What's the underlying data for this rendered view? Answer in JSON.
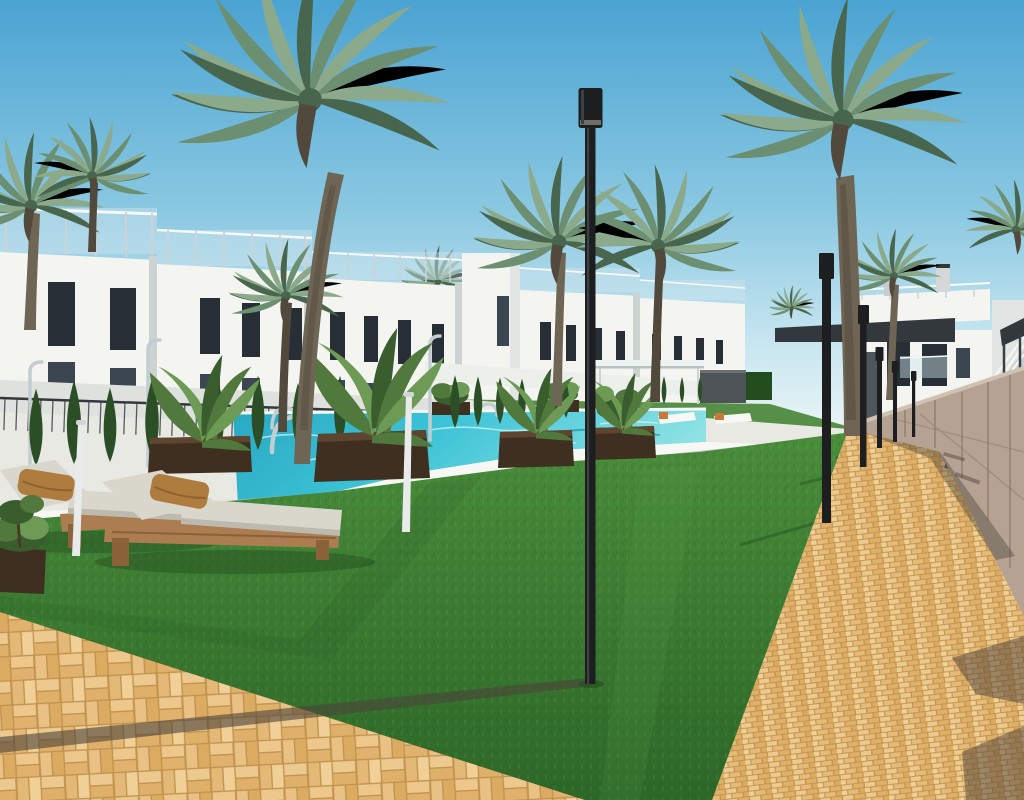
{
  "meta": {
    "title": "Architectural rendering — residential pool courtyard",
    "description": "Photorealistic 3D render: white Mediterranean townhouses with rooftop glass railings, a turquoise pool with wooden planters and tropical plants, cypress trees, tall palm trees, black courtyard light poles, wooden sun loungers with grey cushions and brown pillows on artificial lawn, an ochre brick walkway beside a stone retaining wall, modern grey apartment block and glass cube at right, clear blue sky."
  },
  "scene": {
    "elements": [
      "sky",
      "townhouse-row",
      "rooftop-glass-railings",
      "apartment-building",
      "glass-cube",
      "garden-wall",
      "pergola",
      "storage-box",
      "pool",
      "pool-deck",
      "pool-ladder",
      "water-spout",
      "outdoor-showers",
      "wooden-planters",
      "tropical-plants",
      "cypress-trees",
      "palm-trees",
      "lawn",
      "brick-path",
      "foreground-paving",
      "stone-wall",
      "concrete-strip",
      "stairs",
      "light-poles",
      "sun-loungers",
      "umbrella-poles",
      "shadows",
      "distant-loungers"
    ]
  },
  "palette": {
    "sky_top": "#4aa3d2",
    "sky_mid": "#8cc9e2",
    "sky_low": "#c8e6f0",
    "sky_horizon": "#e9f4f5",
    "wall_white": "#f4f4f1",
    "wall_shade": "#e1e5e3",
    "wall_dark_edge": "#cdd3d1",
    "window_dark": "#272e35",
    "window_mid": "#3b4650",
    "roof_dark": "#33383c",
    "glass_blue": "#cfe4ee",
    "garden_wall": "#edefeb",
    "deck": "#e8e9e3",
    "deck_shade": "#ccd4d2",
    "coping": "#f7f8f4",
    "pool_deep": "#1d96b4",
    "pool_main": "#3cc3d6",
    "pool_pale": "#8fe2e4",
    "ripple": "#c9f0ef",
    "grass_top": "#478a39",
    "grass_bottom": "#2d6728",
    "grass_dark": "#1f4a1c",
    "grass_band": "#568f47",
    "brick": "#dfb06a",
    "brick_lite": "#ecc98f",
    "grout": "#c0934f",
    "path_shadow": "#4b423a",
    "concrete": "#9aa3a9",
    "grate": "#5b6166",
    "stone": "#b5a292",
    "stone_dark": "#8e7b6b",
    "wood": "#5d452f",
    "wood_dark": "#3e2f21",
    "lounge_wood": "#ab7d50",
    "lounge_wood_dark": "#8a6138",
    "cushion": "#d9d6cc",
    "cushion_shade": "#bcb9af",
    "pillow": "#ad7c3e",
    "pillow_dark": "#8f6330",
    "cypress": "#2c4e26",
    "plant1": "#51793e",
    "plant2": "#6d9a55",
    "plant3": "#3a5d2e",
    "palm1": "#6c8f72",
    "palm2": "#8ba98b",
    "palm3": "#48664d",
    "trunk": "#6e6555",
    "trunk_dark": "#52493d",
    "pole": "#1c1e20",
    "chrome": "#c3cdd1",
    "orange": "#c8793a",
    "glass_green": "#3fae9d",
    "glass_pale": "#d9e9e6",
    "pergola": "#eef2f1",
    "box_dark": "#4d5356",
    "shadow_green": "#234c1f"
  }
}
